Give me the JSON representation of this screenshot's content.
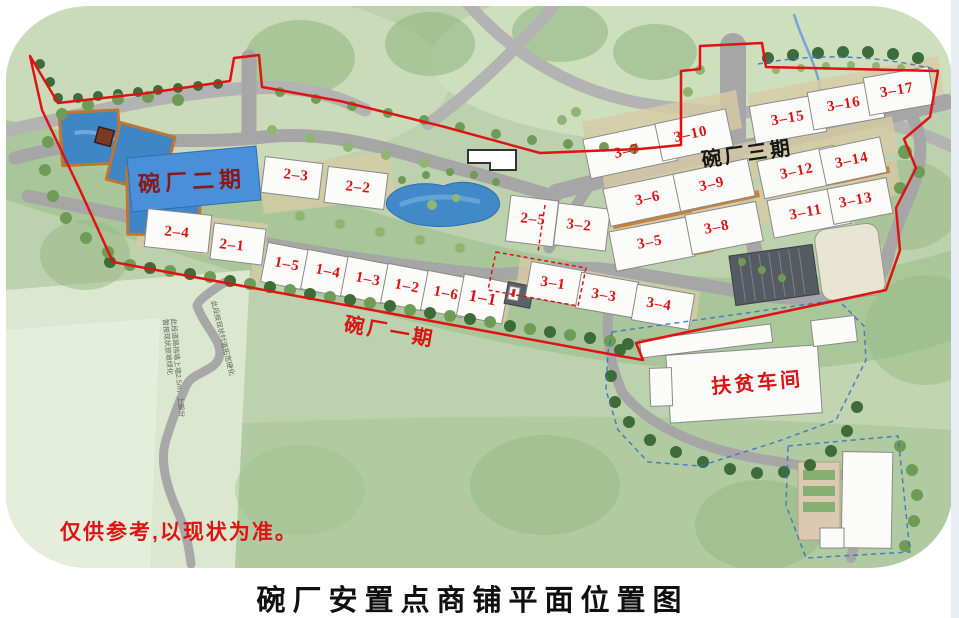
{
  "footer": {
    "title": "碗厂安置点商铺平面位置图"
  },
  "notes": {
    "disclaimer": "仅供参考,以现状为准。"
  },
  "areas": {
    "phase1": "碗厂一期",
    "phase2": "碗厂二期",
    "phase3": "碗厂三期",
    "workshop": "扶贫车间"
  },
  "labels": {
    "b2_3": "2–3",
    "b2_2": "2–2",
    "b2_4": "2–4",
    "b2_1": "2–1",
    "b2_5": "2–5",
    "b1_5": "1–5",
    "b1_4": "1–4",
    "b1_3": "1–3",
    "b1_2": "1–2",
    "b1_6": "1–6",
    "b1_1": "1–1",
    "b3_1": "3–1",
    "b3_2": "3–2",
    "b3_3": "3–3",
    "b3_4": "3–4",
    "b3_5": "3–5",
    "b3_6": "3–6",
    "b3_7": "3–7",
    "b3_8": "3–8",
    "b3_9": "3–9",
    "b3_10": "3–10",
    "b3_11": "3–11",
    "b3_12": "3–12",
    "b3_13": "3–13",
    "b3_14": "3–14",
    "b3_15": "3–15",
    "b3_16": "3–16",
    "b3_17": "3–17"
  },
  "annotations": {
    "note1_line1": "此段道路挡墙上墙2.5m，上部分",
    "note1_line2": "暂按现状放坡绿化",
    "note2": "此段按现状村道拓宽硬化"
  },
  "colors": {
    "label_red": "#d91414",
    "boundary_red": "#e01212",
    "deep_red": "#8c1717",
    "water_blue": "#3f86c6",
    "phase2_panel_blue": "#4a90d9",
    "road_gray": "#a6a6a6",
    "title_black": "#101010"
  }
}
